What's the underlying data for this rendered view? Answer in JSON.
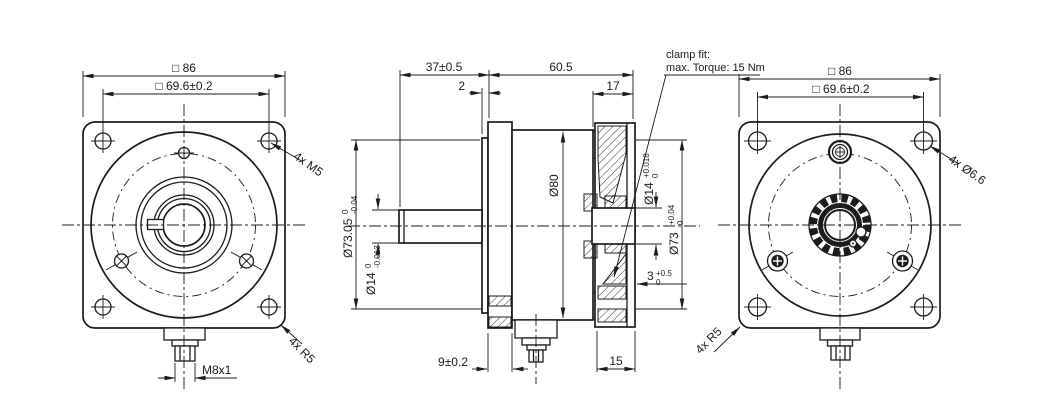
{
  "views": {
    "front": {
      "dim_outer": "□ 86",
      "dim_bolt_circle": "□ 69.6±0.2",
      "label_screws": "4x M5",
      "label_corner_radius": "4x R5",
      "label_connector_thread": "M8x1"
    },
    "side": {
      "dim_front_length": "37±0.5",
      "dim_housing_length": "60.5",
      "dim_pilot_step": "2",
      "dim_rear_width": "17",
      "dim_housing_dia": "Ø80",
      "dim_pilot_dia": {
        "main": "Ø73.05",
        "top": "0",
        "bottom": "-0.04"
      },
      "dim_shaft_dia": {
        "main": "Ø14",
        "top": "0",
        "bottom": "-0.013"
      },
      "dim_bore_dia": {
        "main": "Ø14",
        "top": "+0.018",
        "bottom": "0"
      },
      "dim_recess_dia": {
        "main": "Ø73",
        "top": "+0.04",
        "bottom": "0"
      },
      "dim_recess_depth": {
        "main": "3",
        "top": "+0.5",
        "bottom": "0"
      },
      "dim_flange_thickness": "9±0.2",
      "dim_rear_thickness": "15",
      "note_clamp": {
        "line1": "clamp fit:",
        "line2": "max. Torque: 15 Nm"
      }
    },
    "rear": {
      "dim_outer": "□ 86",
      "dim_bolt_circle": "□ 69.6±0.2",
      "label_holes": "4x Ø6.6",
      "label_corner_radius": "4x R5"
    }
  }
}
